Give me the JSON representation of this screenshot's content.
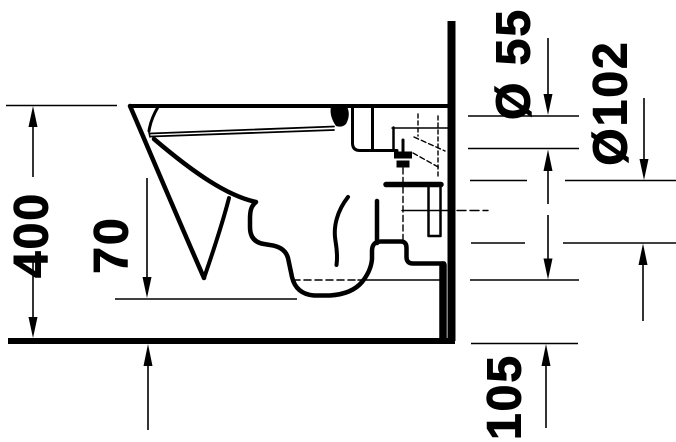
{
  "drawing": {
    "kind": "technical-drawing",
    "subject": "wall-hung toilet side section with installation dimensions",
    "background_color": "#ffffff",
    "line_color": "#000000"
  },
  "dimensions": {
    "overall_height": "400",
    "trap_bottom_height": "70",
    "flush_pipe_diameter": "Ø 55",
    "outlet_diameter": "Ø102",
    "outlet_height": "105"
  }
}
